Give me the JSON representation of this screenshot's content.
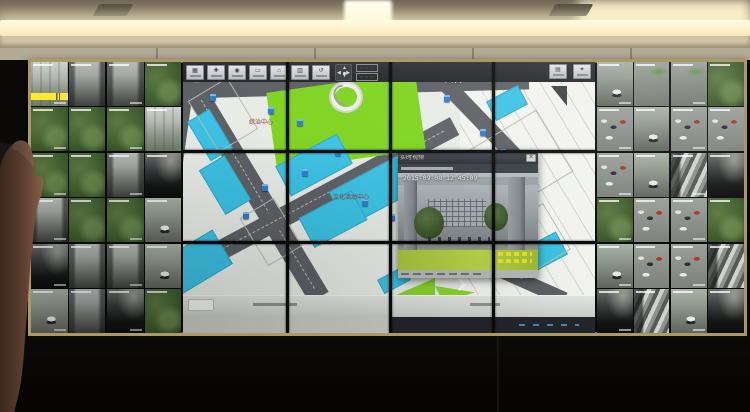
{
  "colors": {
    "frame_gold": "#ab9968",
    "map_cyan": "#3cc2e4",
    "lawn_green": "#7fd41f",
    "road_gray": "#5d6165",
    "alarm_yellow": "#ffe92e",
    "marker_blue": "#2f7fd0",
    "osd_yellow": "#e8e12f",
    "paper": "#e9ebe6",
    "cad_white": "#f2f3ef"
  },
  "video_wall": {
    "sections": {
      "left": {
        "rows": 3,
        "cols": 2,
        "variants": [
          1,
          3,
          2,
          2,
          3,
          2,
          2,
          1,
          2,
          2,
          3,
          2,
          3,
          4,
          2,
          5,
          4,
          3,
          5,
          3,
          3,
          5,
          4,
          2
        ]
      },
      "right": {
        "rows": 3,
        "cols": 2,
        "variants": [
          5,
          8,
          6,
          5,
          8,
          2,
          6,
          6,
          6,
          5,
          2,
          6,
          7,
          4,
          6,
          2,
          5,
          6,
          4,
          7,
          6,
          7,
          5,
          4
        ]
      }
    },
    "alarm_feed_index": 0
  },
  "map": {
    "entrance_label": "入口",
    "labels": [
      {
        "text": "综治中心",
        "x": 66,
        "y": 58
      },
      {
        "text": "文化活动中心",
        "x": 150,
        "y": 133
      },
      {
        "text": "服务中心",
        "x": 226,
        "y": 168
      }
    ],
    "camera_icons": [
      [
        27,
        32
      ],
      [
        85,
        45
      ],
      [
        114,
        57
      ],
      [
        152,
        87
      ],
      [
        119,
        107
      ],
      [
        79,
        122
      ],
      [
        179,
        137
      ],
      [
        206,
        152
      ],
      [
        261,
        33
      ],
      [
        297,
        67
      ],
      [
        317,
        87
      ],
      [
        340,
        147
      ],
      [
        232,
        120
      ],
      [
        60,
        150
      ]
    ],
    "toolbar_glyphs": [
      "▦",
      "✚",
      "◉",
      "▭",
      "⌂",
      "▥",
      "↺"
    ],
    "right_toolbar_glyphs": [
      "▤",
      "✦"
    ],
    "pan": {
      "up": "▲",
      "down": "▼",
      "left": "◀",
      "right": "▶"
    }
  },
  "popup": {
    "title": "实时视频",
    "timestamp": "2015-09-08 12:45:09",
    "close_glyph": "×"
  }
}
